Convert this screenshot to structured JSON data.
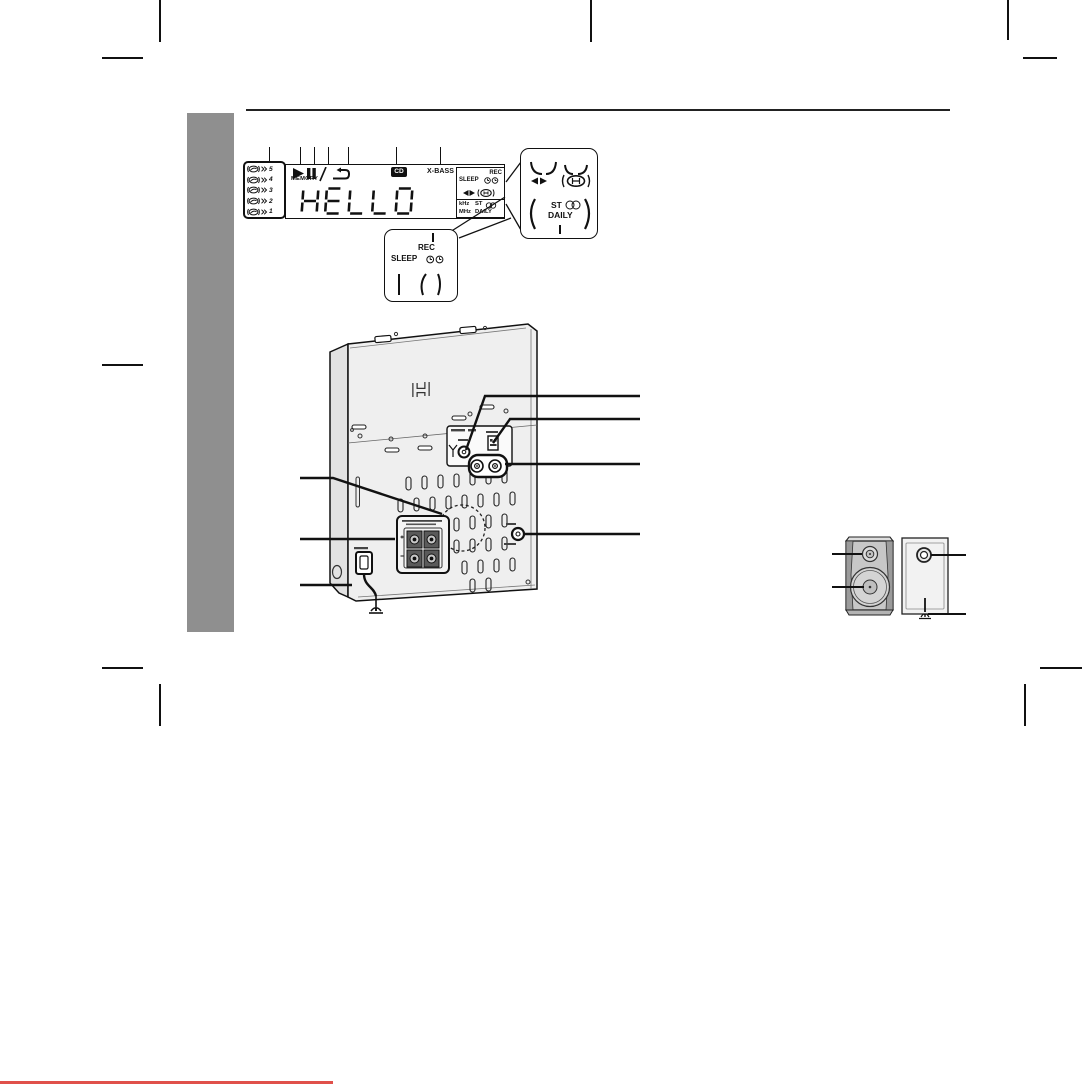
{
  "figure_display": {
    "disc_numbers": [
      "5",
      "4",
      "3",
      "2",
      "1"
    ],
    "memory": "MEMORY",
    "segment_text": "HELLO",
    "cd_badge": "CD",
    "xbass": "X-BASS",
    "rec": "REC",
    "sleep": "SLEEP",
    "khz": "kHz",
    "mhz": "MHz",
    "st": "ST",
    "daily": "DAILY",
    "icons": [
      "disc-icon",
      "play-icon",
      "pause-icon",
      "repeat-icon",
      "clock-icon",
      "tape-direction-icon",
      "reverse-mode-icon",
      "stereo-icon"
    ]
  },
  "figure_magnified": {
    "st": "ST",
    "daily": "DAILY"
  },
  "figure_timer_callout": {
    "rec": "REC",
    "sleep": "SLEEP"
  },
  "colors": {
    "sidebar_gray": "#8f8f8f",
    "accent_red": "#e0504a",
    "ink": "#111111"
  }
}
